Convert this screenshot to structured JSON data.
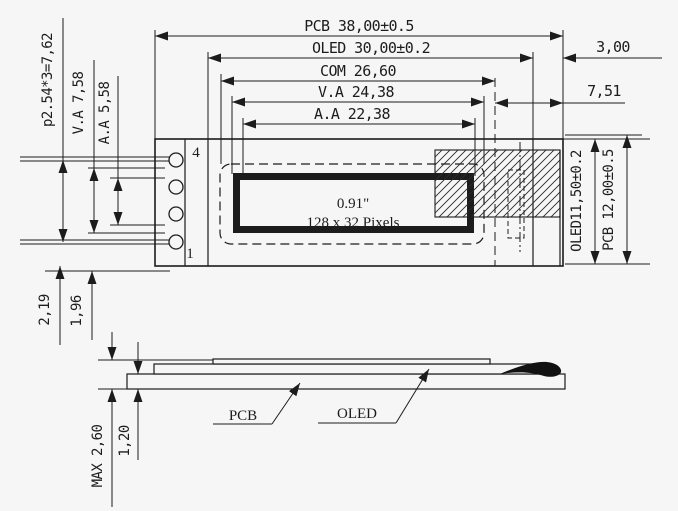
{
  "drawing": {
    "title_context": "0.91 inch OLED module mechanical drawing",
    "top_dimensions": {
      "pcb_width": "PCB 38,00±0.5",
      "oled_width": "OLED 30,00±0.2",
      "com_width": "COM 26,60",
      "va_width": "V.A 24,38",
      "aa_width": "A.A 22,38",
      "edge_gap": "3,00",
      "right_offset": "7,51"
    },
    "left_dimensions": {
      "pin_pitch": "p2.54*3=7,62",
      "va_height": "V.A 7,58",
      "aa_height": "A.A 5,58",
      "pin_edge_a": "2,19",
      "pin_edge_b": "1,96"
    },
    "right_dimensions": {
      "oled_height": "OLED11,50±0.2",
      "pcb_height": "PCB 12,00±0.5"
    },
    "side_dimensions": {
      "max_thickness": "MAX 2,60",
      "pcb_thickness": "1,20"
    },
    "display_area": {
      "size_label": "0.91\"",
      "resolution_label": "128 x 32 Pixels"
    },
    "pins": {
      "top_pin": "4",
      "bottom_pin": "1"
    },
    "side_labels": {
      "pcb": "PCB",
      "oled": "OLED"
    },
    "colors": {
      "line": "#1c1c1c",
      "paper": "#f6f6f6"
    }
  }
}
